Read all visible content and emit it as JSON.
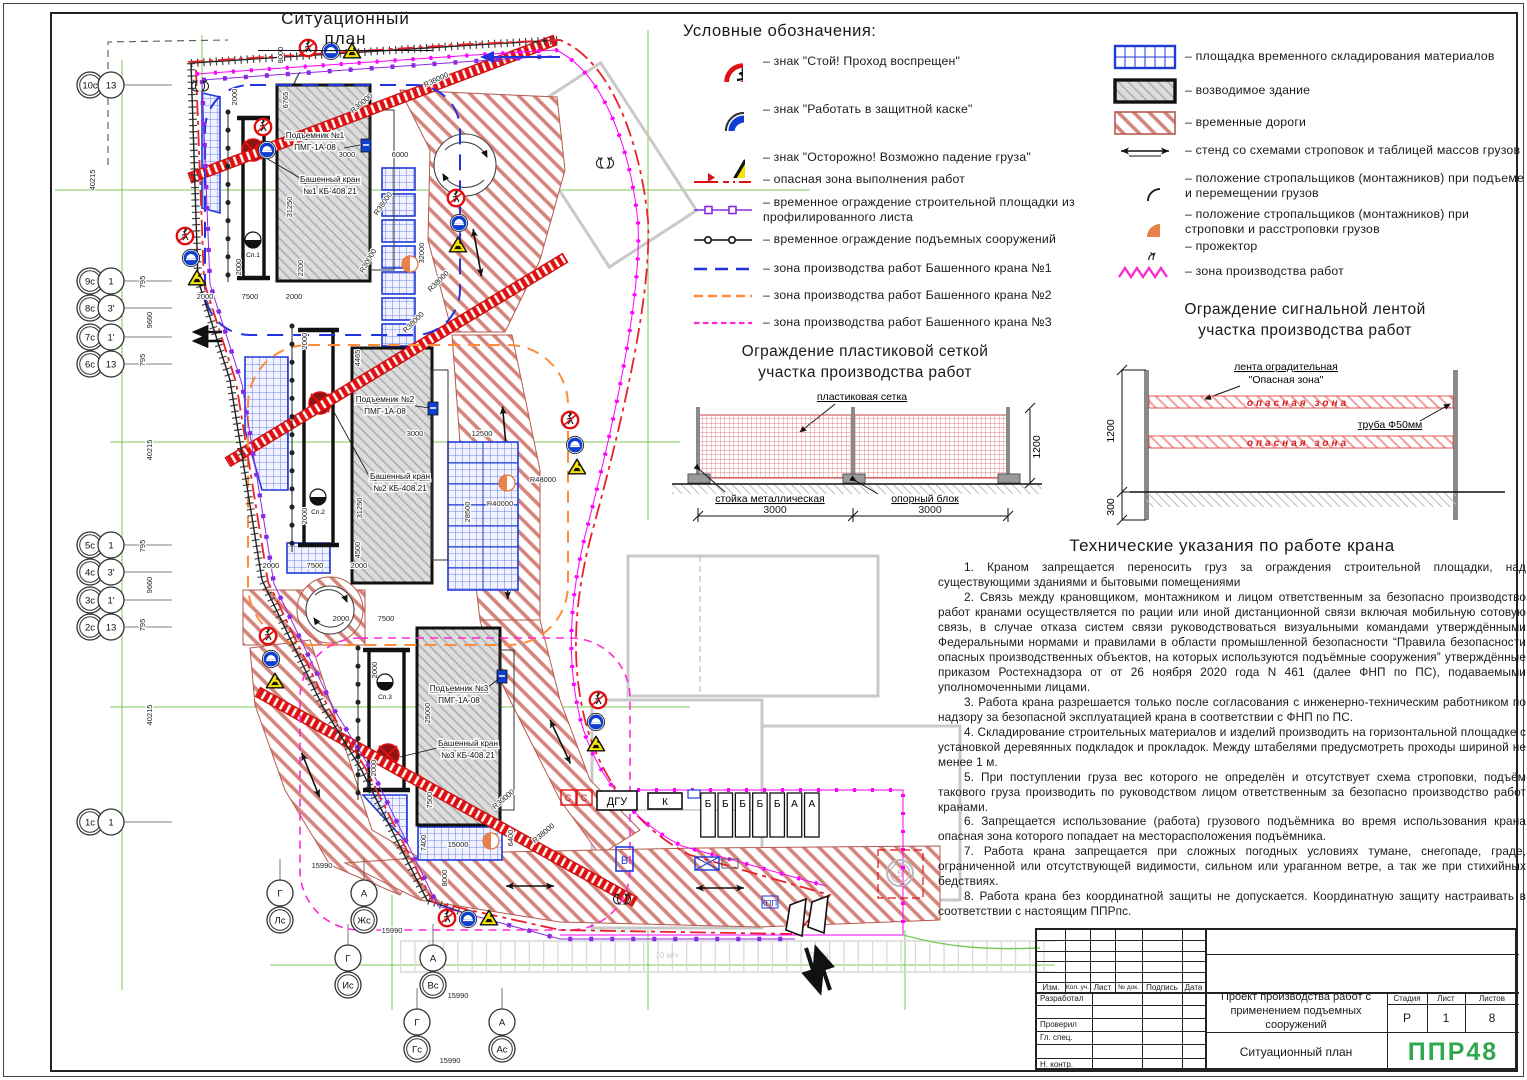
{
  "plan": {
    "title": "Ситуационный план",
    "axes_left": [
      {
        "a": "10с",
        "b": "13"
      },
      {
        "a": "9с",
        "b": "1"
      },
      {
        "a": "8с",
        "b": "3'"
      },
      {
        "a": "7с",
        "b": "1'"
      },
      {
        "a": "6с",
        "b": "13"
      },
      {
        "a": "5с",
        "b": "1"
      },
      {
        "a": "4с",
        "b": "3'"
      },
      {
        "a": "3с",
        "b": "1'"
      },
      {
        "a": "2с",
        "b": "13"
      },
      {
        "a": "1с",
        "b": "1"
      }
    ],
    "axes_bottom": [
      {
        "a": "Г",
        "b": "Лс"
      },
      {
        "a": "А",
        "b": "Жс"
      },
      {
        "a": "Г",
        "b": "Ис"
      },
      {
        "a": "А",
        "b": "Вс"
      },
      {
        "a": "Г",
        "b": "Гс"
      },
      {
        "a": "А",
        "b": "Ас"
      }
    ],
    "cranes": [
      {
        "lift1": "Подъемник №1",
        "lift2": "ПМГ-1А-08",
        "crane1": "Башенный кран",
        "crane2": "№1 КБ-408.21"
      },
      {
        "lift1": "Подъемник №2",
        "lift2": "ПМГ-1А-08",
        "crane1": "Башенный кран",
        "crane2": "№2 КБ-408.21"
      },
      {
        "lift1": "Подъемник №3",
        "lift2": "ПМГ-1А-08",
        "crane1": "Башенный кран",
        "crane2": "№3 КБ-408.21"
      }
    ],
    "sp_labels": [
      "Сп.1",
      "Сп.2",
      "Сп.3"
    ],
    "blocks": [
      "Б",
      "Б",
      "Б",
      "Б",
      "Б",
      "А",
      "А"
    ],
    "misc": {
      "dgu": "ДГУ",
      "k": "К",
      "v": "В",
      "s1": "С",
      "s2": "С",
      "kpp": "КПП",
      "five": "5",
      "parking1": "10 м/ч",
      "parking2": "10 м/ч"
    },
    "dims": [
      "8000",
      "2000",
      "6765",
      "3000",
      "6000",
      "31250",
      "2200",
      "2000",
      "32000",
      "2000",
      "7500",
      "2000",
      "2000",
      "4465",
      "3000",
      "12500",
      "31250",
      "2000",
      "28500",
      "4500",
      "2000",
      "7500",
      "2000",
      "2000",
      "7500",
      "2000",
      "25000",
      "2000",
      "7500",
      "7400",
      "15000",
      "6400",
      "8000",
      "15990",
      "15990",
      "15990",
      "15990",
      "40215",
      "795",
      "9660",
      "795",
      "40215",
      "795",
      "9660",
      "795",
      "40215",
      "R38000",
      "R30000",
      "R38000",
      "R38000",
      "R38000",
      "R48000",
      "R40000",
      "R30000",
      "R38000",
      "R30000"
    ]
  },
  "legend": {
    "title": "Условные обозначения:",
    "signs": [
      {
        "label": "– знак \"Стой! Проход воспрещен\""
      },
      {
        "label": "– знак \"Работать в защитной каске\""
      },
      {
        "label": "– знак \"Осторожно! Возможно падение груза\""
      }
    ],
    "lines": [
      {
        "label": "– опасная зона выполнения работ"
      },
      {
        "label": "– временное ограждение строительной площадки из профилированного листа"
      },
      {
        "label": "– временное ограждение подъемных сооружений"
      },
      {
        "label": "– зона производства работ Башенного крана №1"
      },
      {
        "label": "– зона производства работ Башенного крана №2"
      },
      {
        "label": "– зона производства работ Башенного крана №3"
      }
    ],
    "areas": [
      {
        "label": "– площадка временного складирования материалов"
      },
      {
        "label": "– возводимое здание"
      },
      {
        "label": "– временные дороги"
      },
      {
        "label": "– стенд со схемами строповок и таблицей массов грузов"
      },
      {
        "label": "– положение стропальщиков (монтажников) при подъеме и перемещении грузов"
      },
      {
        "label": "– положение стропальщиков (монтажников) при строповки и расстроповки грузов"
      },
      {
        "label": "– прожектор"
      },
      {
        "label": "– зона производства работ"
      }
    ]
  },
  "mesh_fence": {
    "title1": "Ограждение пластиковой сеткой",
    "title2": "участка производства работ",
    "net": "пластиковая сетка",
    "post": "стойка металлическая",
    "block": "опорный блок",
    "dim1": "3000",
    "dim2": "3000",
    "height": "1200"
  },
  "tape_fence": {
    "title1": "Ограждение сигнальной лентой",
    "title2": "участка производства работ",
    "tape1": "лента оградительная",
    "tape2": "\"Опасная зона\"",
    "zone": "опасная зона",
    "pipe": "труба Ф50мм",
    "height": "1200",
    "depth": "300"
  },
  "tech": {
    "title": "Технические указания по работе крана",
    "items": [
      "1. Краном запрещается переносить груз за ограждения строительной площадки, над существующими зданиями и бытовыми помещениями",
      "2. Связь между крановщиком, монтажником и лицом ответственным за безопасно производство работ кранами осуществляется по рации или иной дистанционной связи включая мобильную сотовую связь, в случае отказа систем связи руководствоваться визуальными командами  утверждёнными Федеральными нормами и правилами в области промышленной безопасности “Правила безопасности опасных производственных объектов, на которых используются подъёмные сооружения” утверждённые приказом Ростехнадзора от от 26 ноября 2020 года N 461 (далее ФНП по ПС), подаваемыми уполномоченными лицами.",
      "3. Работа крана разрешается только после согласования с инженерно-техническим работником по надзору за безопасной эксплуатацией крана в соответствии с ФНП по ПС.",
      "4. Складирование строительных материалов и изделий производить на горизонтальной площадке с установкой деревянных подкладок и прокладок. Между штабелями предусмотреть проходы шириной не менее 1 м.",
      "5. При поступлении груза вес которого не определён и отсутствует схема строповки, подъём такового груза производить по руководством лицом ответственным за безопасно производство работ кранами.",
      "6. Запрещается использование (работа) грузового подъёмника во время использования крана опасная зона которого попадает на месторасположения подъёмника.",
      "7. Работа крана запрещается при сложных погодных условиях тумане, снегопаде, граде, ограниченной или отсутствующей видимости, сильном или ураганном ветре, а так же при стихийных бедствиях.",
      "8. Работа крана без координатной защиты не допускается. Координатную защиту настраивать в соответствии с настоящим ППРпс."
    ]
  },
  "titleblock": {
    "cols": [
      "Изм.",
      "Кол. уч.",
      "Лист",
      "№ док.",
      "Подпись",
      "Дата"
    ],
    "roles": [
      "Разработал",
      "Проверил",
      "Гл. спец.",
      "Н. контр."
    ],
    "doc1": "Проект производства работ с",
    "doc2": "применением подъемных сооружений",
    "name": "Ситуационный план",
    "stage_l": "Стадия",
    "sheet_l": "Лист",
    "sheets_l": "Листов",
    "stage": "Р",
    "sheet": "1",
    "sheets": "8",
    "logo": "ППР48"
  },
  "colors": {
    "accent_green": "#2fa84f",
    "danger_red": "#e01010",
    "magenta": "#ff00ff",
    "orange": "#ff8c3a",
    "blue": "#2233dd",
    "violet": "#8a2be2"
  }
}
